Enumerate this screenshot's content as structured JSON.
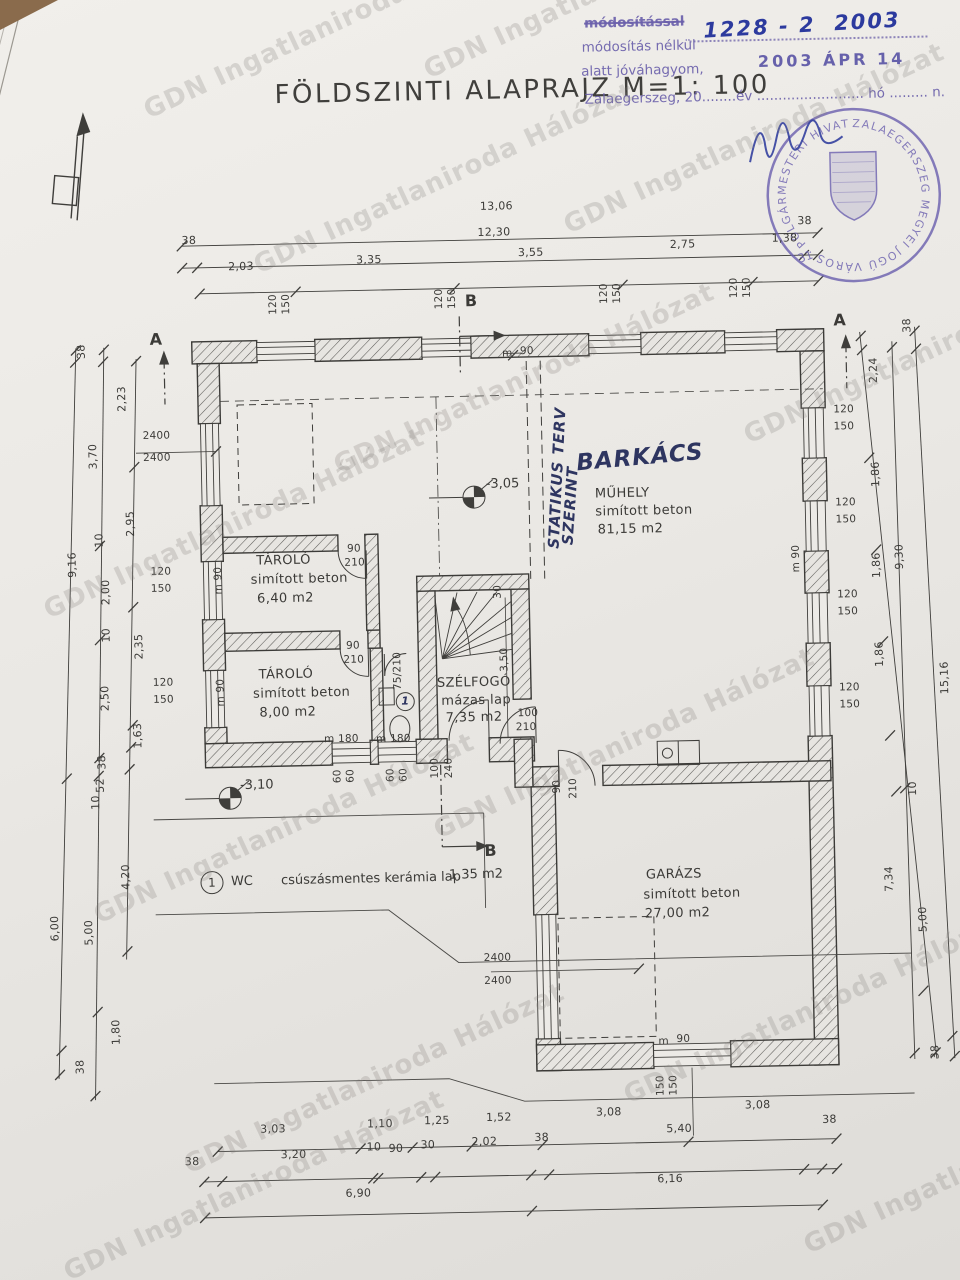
{
  "title": {
    "text": "FÖLDSZINTI ALAPRAJZ M=1: 100"
  },
  "approval": {
    "line1": "módosítással",
    "line2": "módosítás nélkül",
    "line3": "alatt jóváhagyom,",
    "line4": "Zalaegerszeg, 20........év ......................... hó ......... n.",
    "file_number": "1228 - 2  2003",
    "date_stamp": "2003 ÁPR 14"
  },
  "seal": {
    "ring_text": "ZALAEGERSZEG MEGYEI JOGÚ VÁROS · POLGÁRMESTERI HIVATALA ·",
    "number": "31"
  },
  "watermark_items": [
    {
      "t": "GDN Ingatlaniroda Hálózat",
      "x": 140,
      "y": 100,
      "r": -25
    },
    {
      "t": "GDN Ingatlaniroda Hálózat",
      "x": 420,
      "y": 60,
      "r": -25
    },
    {
      "t": "GDN Ingatlaniroda Hálózat",
      "x": 250,
      "y": 255,
      "r": -25
    },
    {
      "t": "GDN Ingatlaniroda Hálózat",
      "x": 560,
      "y": 215,
      "r": -25
    },
    {
      "t": "GDN Ingatlaniroda Hálózat",
      "x": 40,
      "y": 600,
      "r": -25
    },
    {
      "t": "GDN Ingatlaniroda Hálózat",
      "x": 330,
      "y": 455,
      "r": -25
    },
    {
      "t": "GDN Ingatlaniroda Hálózat",
      "x": 740,
      "y": 425,
      "r": -25
    },
    {
      "t": "GDN Ingatlaniroda Hálózat",
      "x": 90,
      "y": 905,
      "r": -25
    },
    {
      "t": "GDN Ingatlaniroda Hálózat",
      "x": 430,
      "y": 820,
      "r": -25
    },
    {
      "t": "GDN Ingatlaniroda Hálózat",
      "x": 180,
      "y": 1155,
      "r": -25
    },
    {
      "t": "GDN Ingatlaniroda Hálózat",
      "x": 620,
      "y": 1085,
      "r": -25
    },
    {
      "t": "GDN Ingatlaniroda Hálózat",
      "x": 800,
      "y": 1235,
      "r": -25
    },
    {
      "t": "GDN Ingatlaniroda Hálózat",
      "x": 60,
      "y": 1262,
      "r": -25
    }
  ],
  "plan": {
    "dimension_labels": [
      {
        "t": "13,06",
        "x": 489,
        "y": 201
      },
      {
        "t": "38",
        "x": 190,
        "y": 229
      },
      {
        "t": "12,30",
        "x": 486,
        "y": 227
      },
      {
        "t": "38",
        "x": 806,
        "y": 222
      },
      {
        "t": "2,03",
        "x": 236,
        "y": 256
      },
      {
        "t": "3,35",
        "x": 364,
        "y": 252
      },
      {
        "t": "3,55",
        "x": 526,
        "y": 248
      },
      {
        "t": "2,75",
        "x": 678,
        "y": 243
      },
      {
        "t": "1,38",
        "x": 780,
        "y": 239
      },
      {
        "t": "38",
        "x": 80,
        "y": 338,
        "r": -90
      },
      {
        "t": "2,23",
        "x": 114,
        "y": 386,
        "r": -90
      },
      {
        "t": "3,70",
        "x": 84,
        "y": 443,
        "r": -90
      },
      {
        "t": "2,95",
        "x": 120,
        "y": 511,
        "r": -90
      },
      {
        "t": "10",
        "x": 94,
        "y": 527,
        "r": -90
      },
      {
        "t": "9,16",
        "x": 61,
        "y": 551,
        "r": -90
      },
      {
        "t": "2,00",
        "x": 94,
        "y": 579,
        "r": -90
      },
      {
        "t": "10",
        "x": 99,
        "y": 622,
        "r": -90
      },
      {
        "t": "2,35",
        "x": 126,
        "y": 634,
        "r": -90
      },
      {
        "t": "2,50",
        "x": 91,
        "y": 685,
        "r": -90
      },
      {
        "t": "1,63",
        "x": 123,
        "y": 723,
        "r": -90
      },
      {
        "t": "38",
        "x": 92,
        "y": 749,
        "r": -90
      },
      {
        "t": "52",
        "x": 90,
        "y": 772,
        "r": -90
      },
      {
        "t": "10",
        "x": 85,
        "y": 789,
        "r": -90
      },
      {
        "t": "4,20",
        "x": 108,
        "y": 864,
        "r": -90
      },
      {
        "t": "6,00",
        "x": 36,
        "y": 914,
        "r": -90
      },
      {
        "t": "5,00",
        "x": 70,
        "y": 919,
        "r": -90
      },
      {
        "t": "1,80",
        "x": 95,
        "y": 1019,
        "r": -90
      },
      {
        "t": "38",
        "x": 64,
        "y": 1053,
        "r": -90
      },
      {
        "t": "38",
        "x": 906,
        "y": 329,
        "r": -90
      },
      {
        "t": "2,24",
        "x": 866,
        "y": 373,
        "r": -90
      },
      {
        "t": "1,86",
        "x": 866,
        "y": 477,
        "r": -90
      },
      {
        "t": "1,86",
        "x": 865,
        "y": 568,
        "r": -90
      },
      {
        "t": "1,86",
        "x": 866,
        "y": 657,
        "r": -90
      },
      {
        "t": "9,30",
        "x": 888,
        "y": 560,
        "r": -90
      },
      {
        "t": "15,16",
        "x": 927,
        "y": 682,
        "r": -90
      },
      {
        "t": "10",
        "x": 902,
        "y": 792,
        "r": -90
      },
      {
        "t": "7,34",
        "x": 871,
        "y": 882,
        "r": -90
      },
      {
        "t": "5,00",
        "x": 904,
        "y": 923,
        "r": -90
      },
      {
        "t": "38",
        "x": 919,
        "y": 1056,
        "r": -90
      },
      {
        "t": "3,03",
        "x": 250,
        "y": 1119
      },
      {
        "t": "1,10",
        "x": 357,
        "y": 1116
      },
      {
        "t": "1,25",
        "x": 414,
        "y": 1114
      },
      {
        "t": "1,52",
        "x": 476,
        "y": 1112
      },
      {
        "t": "3,08",
        "x": 586,
        "y": 1109
      },
      {
        "t": "3,08",
        "x": 735,
        "y": 1105
      },
      {
        "t": "38",
        "x": 174,
        "y": 1150
      },
      {
        "t": "3,20",
        "x": 270,
        "y": 1145
      },
      {
        "t": "10",
        "x": 356,
        "y": 1139
      },
      {
        "t": "90",
        "x": 378,
        "y": 1141
      },
      {
        "t": "30",
        "x": 410,
        "y": 1138
      },
      {
        "t": "2,02",
        "x": 461,
        "y": 1136
      },
      {
        "t": "38",
        "x": 524,
        "y": 1133
      },
      {
        "t": "5,40",
        "x": 656,
        "y": 1127
      },
      {
        "t": "38",
        "x": 812,
        "y": 1121
      },
      {
        "t": "6,90",
        "x": 334,
        "y": 1185
      },
      {
        "t": "6,16",
        "x": 646,
        "y": 1177
      }
    ],
    "window_door_labels": [
      {
        "t": "120",
        "x": 270,
        "y": 295,
        "r": -90
      },
      {
        "t": "150",
        "x": 283,
        "y": 295,
        "r": -90
      },
      {
        "t": "120",
        "x": 436,
        "y": 293,
        "r": -90
      },
      {
        "t": "150",
        "x": 449,
        "y": 293,
        "r": -90
      },
      {
        "t": "120",
        "x": 601,
        "y": 291,
        "r": -90
      },
      {
        "t": "150",
        "x": 614,
        "y": 291,
        "r": -90
      },
      {
        "t": "120",
        "x": 731,
        "y": 288,
        "r": -90
      },
      {
        "t": "150",
        "x": 744,
        "y": 288,
        "r": -90
      },
      {
        "t": "2400",
        "x": 147,
        "y": 424
      },
      {
        "t": "2400",
        "x": 147,
        "y": 446
      },
      {
        "t": "120",
        "x": 152,
        "y": 560
      },
      {
        "t": "150",
        "x": 152,
        "y": 577
      },
      {
        "t": "120",
        "x": 152,
        "y": 671
      },
      {
        "t": "150",
        "x": 152,
        "y": 688
      },
      {
        "t": "m 90",
        "x": 206,
        "y": 570,
        "r": -90
      },
      {
        "t": "m 90",
        "x": 206,
        "y": 682,
        "r": -90
      },
      {
        "t": "120",
        "x": 838,
        "y": 412
      },
      {
        "t": "150",
        "x": 838,
        "y": 429
      },
      {
        "t": "120",
        "x": 838,
        "y": 505
      },
      {
        "t": "150",
        "x": 838,
        "y": 522
      },
      {
        "t": "120",
        "x": 838,
        "y": 597
      },
      {
        "t": "150",
        "x": 838,
        "y": 614
      },
      {
        "t": "120",
        "x": 838,
        "y": 690
      },
      {
        "t": "150",
        "x": 838,
        "y": 707
      },
      {
        "t": "m 90",
        "x": 784,
        "y": 560,
        "r": -90
      },
      {
        "t": "m",
        "x": 508,
        "y": 349
      },
      {
        "t": "90",
        "x": 526,
        "y": 347
      },
      {
        "t": "90",
        "x": 349,
        "y": 541
      },
      {
        "t": "210",
        "x": 346,
        "y": 555
      },
      {
        "t": "90",
        "x": 346,
        "y": 638
      },
      {
        "t": "210",
        "x": 343,
        "y": 652
      },
      {
        "t": "75/210",
        "x": 378,
        "y": 664,
        "r": -90
      },
      {
        "t": "30",
        "x": 492,
        "y": 587,
        "r": -90
      },
      {
        "t": "3,50",
        "x": 492,
        "y": 655,
        "r": -90
      },
      {
        "t": "100",
        "x": 516,
        "y": 709
      },
      {
        "t": "210",
        "x": 514,
        "y": 723
      },
      {
        "t": "100",
        "x": 422,
        "y": 762,
        "r": -90
      },
      {
        "t": "240",
        "x": 436,
        "y": 762,
        "r": -90
      },
      {
        "t": "90",
        "x": 547,
        "y": 783,
        "r": -90
      },
      {
        "t": "210",
        "x": 560,
        "y": 785,
        "r": -90
      },
      {
        "t": "m 180",
        "x": 322,
        "y": 731
      },
      {
        "t": "m 180",
        "x": 374,
        "y": 732
      },
      {
        "t": "60",
        "x": 328,
        "y": 768,
        "r": -90
      },
      {
        "t": "60",
        "x": 341,
        "y": 768,
        "r": -90
      },
      {
        "t": "60",
        "x": 381,
        "y": 768,
        "r": -90
      },
      {
        "t": "60",
        "x": 394,
        "y": 768,
        "r": -90
      },
      {
        "t": "2400",
        "x": 477,
        "y": 953
      },
      {
        "t": "2400",
        "x": 477,
        "y": 976
      },
      {
        "t": "m",
        "x": 650,
        "y": 1040
      },
      {
        "t": "90",
        "x": 668,
        "y": 1038
      },
      {
        "t": "150",
        "x": 641,
        "y": 1084,
        "r": -90
      },
      {
        "t": "150",
        "x": 654,
        "y": 1084,
        "r": -90
      }
    ],
    "room_labels": [
      {
        "t": "TÁROLÓ",
        "x": 258,
        "y": 550
      },
      {
        "t": "simított beton",
        "x": 252,
        "y": 569
      },
      {
        "t": "6,40 m2",
        "x": 258,
        "y": 588
      },
      {
        "t": "TÁROLÓ",
        "x": 258,
        "y": 664
      },
      {
        "t": "simított beton",
        "x": 252,
        "y": 683
      },
      {
        "t": "8,00 m2",
        "x": 258,
        "y": 702
      },
      {
        "t": "SZÉLFOGÓ",
        "x": 436,
        "y": 676
      },
      {
        "t": "mázas lap",
        "x": 440,
        "y": 694
      },
      {
        "t": "7,35 m2",
        "x": 444,
        "y": 711
      },
      {
        "t": "MŰHELY",
        "x": 598,
        "y": 490
      },
      {
        "t": "simított beton",
        "x": 598,
        "y": 508
      },
      {
        "t": "81,15 m2",
        "x": 600,
        "y": 526
      },
      {
        "t": "GARÁZS",
        "x": 641,
        "y": 872
      },
      {
        "t": "simított beton",
        "x": 638,
        "y": 892
      },
      {
        "t": "27,00 m2",
        "x": 639,
        "y": 911
      }
    ],
    "level_markers": [
      {
        "t": "-3,05",
        "x": 489,
        "y": 478
      },
      {
        "t": "-3,10",
        "x": 237,
        "y": 774
      }
    ],
    "section_markers": [
      {
        "t": "B",
        "x": 472,
        "y": 293
      },
      {
        "t": "B",
        "x": 480,
        "y": 843
      },
      {
        "t": "A",
        "x": 156,
        "y": 325
      },
      {
        "t": "A",
        "x": 840,
        "y": 320
      }
    ],
    "legend_items": [
      {
        "t": "1",
        "x": 203,
        "y": 871,
        "fs": 12
      },
      {
        "t": "WC",
        "x": 226,
        "y": 870
      },
      {
        "t": "csúszásmentes kerámia lap",
        "x": 276,
        "y": 870
      },
      {
        "t": "1,35 m2",
        "x": 444,
        "y": 868
      }
    ],
    "annotations": [
      {
        "t": "BARKÁCS",
        "x": 580,
        "y": 450,
        "fs": 23,
        "r": -4
      },
      {
        "t": "STATIKUS TERV",
        "x": 490,
        "y": 472,
        "r": -86
      },
      {
        "t": "SZERINT",
        "x": 534,
        "y": 500,
        "r": -85
      },
      {
        "t": "1",
        "x": 400,
        "y": 694,
        "fs": 11
      }
    ]
  }
}
